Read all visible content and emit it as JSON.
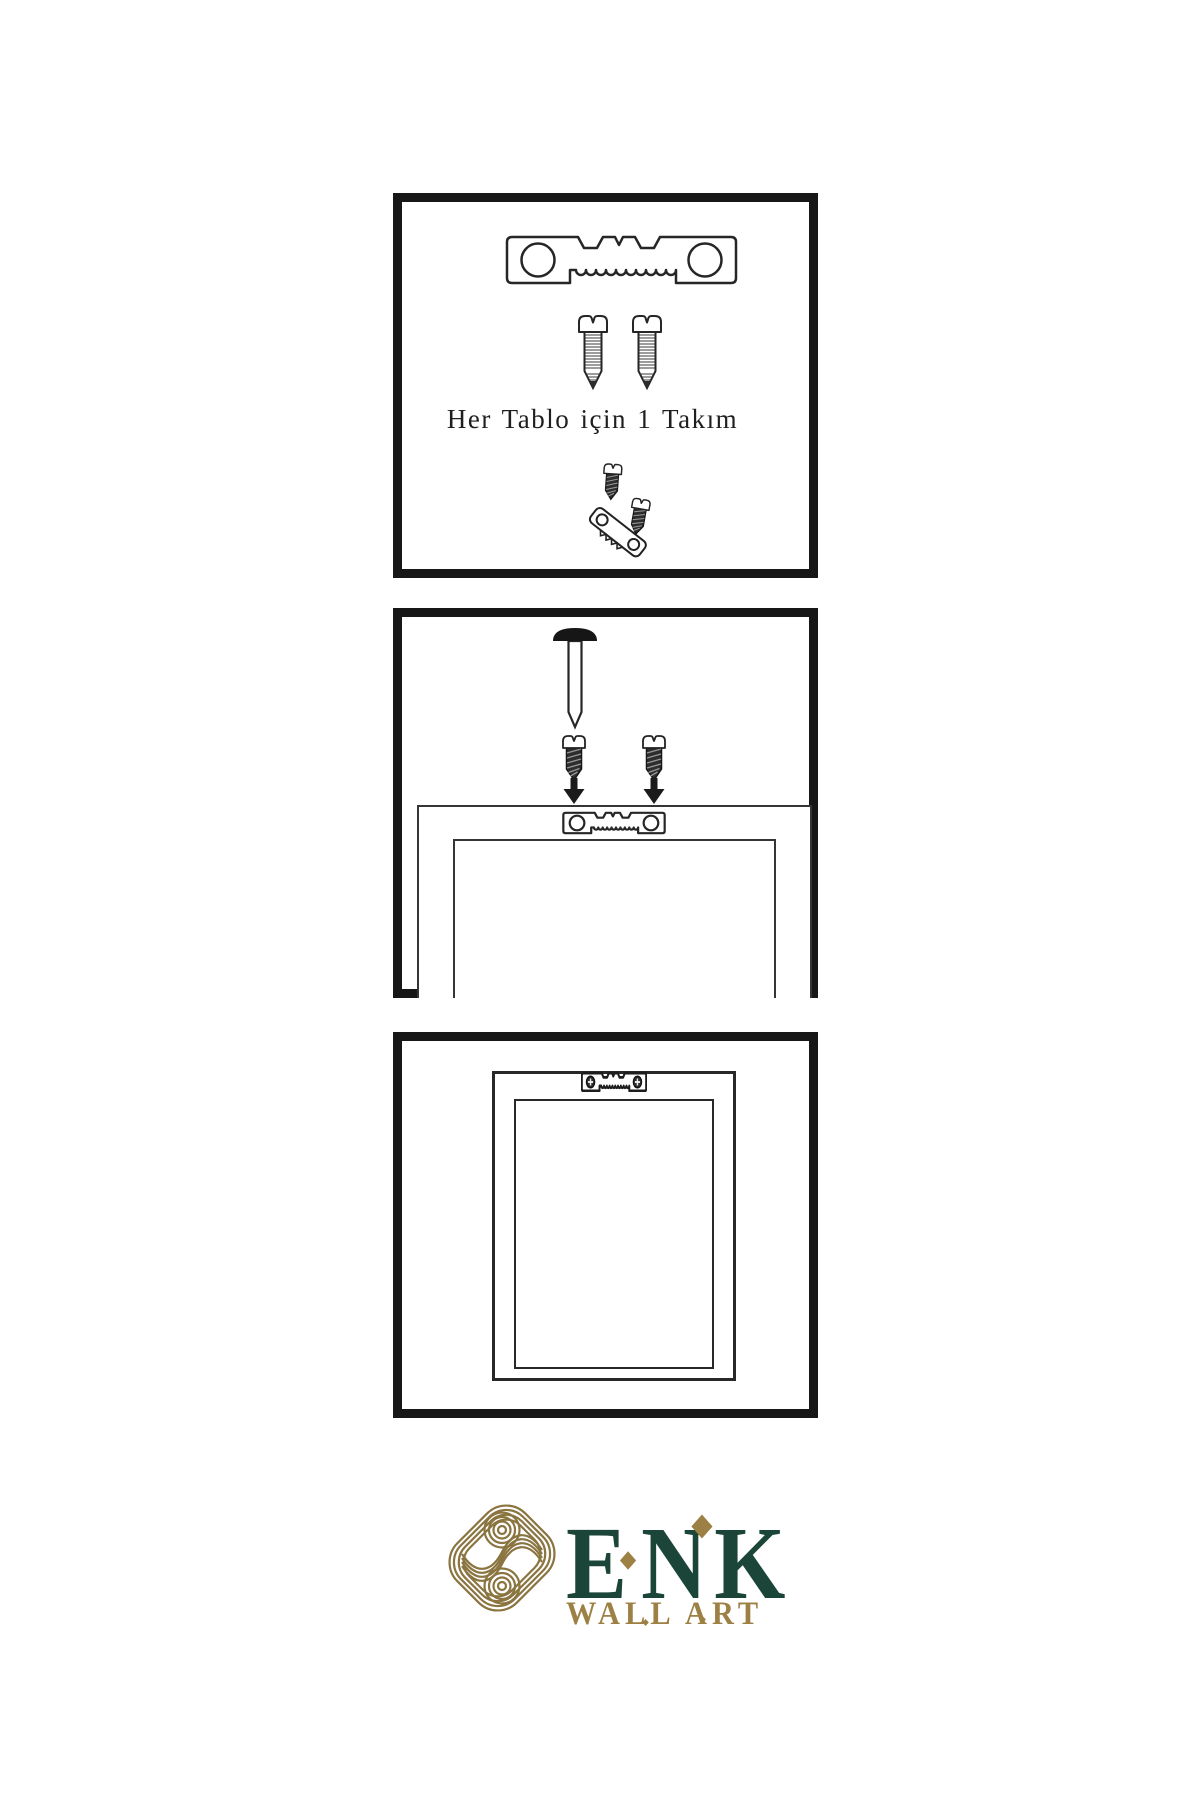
{
  "meta": {
    "background": "#ffffff",
    "ink": "#262626"
  },
  "steps": [
    {
      "name": "hardware-kit",
      "caption": "Her Tablo için 1 Takım",
      "icons": [
        "sawtooth-hanger-icon",
        "screw-icon",
        "screw-icon",
        "angled-hanger-with-screws-icon"
      ]
    },
    {
      "name": "wall-installation",
      "icons": [
        "wall-nail-icon",
        "dark-screw-icon",
        "dark-screw-icon",
        "arrow-down-icon",
        "arrow-down-icon",
        "sawtooth-hanger-icon",
        "frame-back"
      ]
    },
    {
      "name": "hung-frame",
      "icons": [
        "frame-front",
        "mounted-hanger-icon"
      ]
    }
  ],
  "brand": {
    "name": "ENK",
    "tagline": "WALL ART",
    "logo": "knot-logo-icon",
    "colors": {
      "green": "#1c4539",
      "gold": "#9d8044",
      "knot_gold": "#8a7440"
    }
  }
}
